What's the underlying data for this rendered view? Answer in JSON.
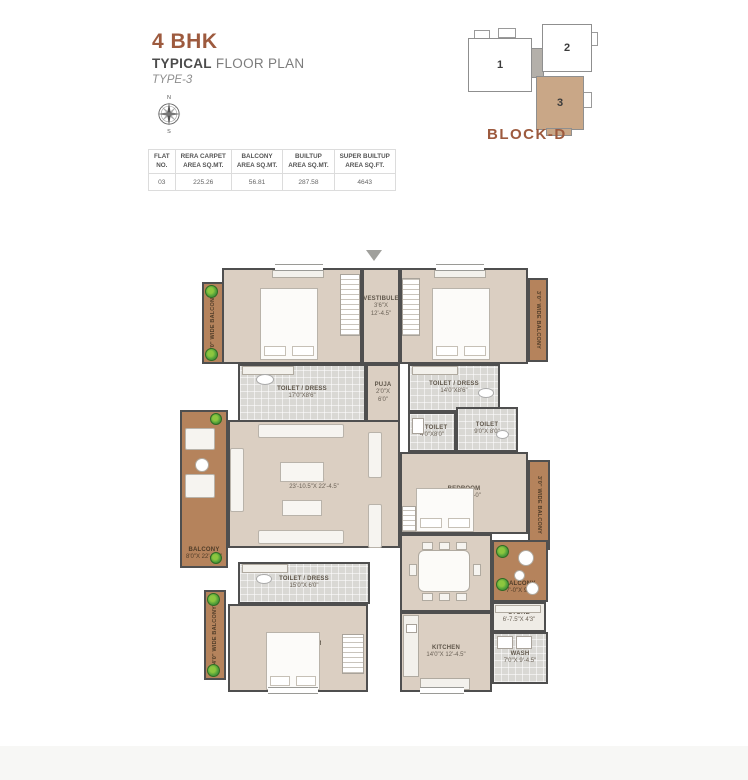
{
  "header": {
    "title": "4 BHK",
    "subtitle_bold": "TYPICAL",
    "subtitle_rest": " FLOOR PLAN",
    "type_label": "TYPE-3",
    "accent_color": "#9d5a3e"
  },
  "compass": {
    "north": "N",
    "south": "S"
  },
  "key_plan": {
    "units": [
      "1",
      "2",
      "3"
    ],
    "caption_prefix": "BLOCK-",
    "caption_bold": "D",
    "highlight_color": "#c9a787"
  },
  "table": {
    "headers": [
      "FLAT\nNO.",
      "RERA CARPET\nAREA SQ.MT.",
      "BALCONY\nAREA SQ.MT.",
      "BUILTUP\nAREA SQ.MT.",
      "SUPER BUILTUP\nAREA SQ.FT."
    ],
    "rows": [
      [
        "03",
        "225.26",
        "56.81",
        "287.58",
        "4643"
      ]
    ]
  },
  "plan": {
    "colors": {
      "room": "#dbcfc2",
      "balcony": "#b5835c",
      "wet": "#d9d8d4",
      "wall": "#4f4f4f",
      "plant": "#4e9d3a"
    },
    "rooms": [
      {
        "id": "bedroom-top-left",
        "label": "BEDROOM",
        "dims": "18'0\"X12'0\"",
        "x": 42,
        "y": 6,
        "w": 140,
        "h": 96,
        "type": "room"
      },
      {
        "id": "balcony-top-left",
        "label": "4'0\" WIDE BALCONY",
        "x": 22,
        "y": 20,
        "w": 22,
        "h": 82,
        "type": "balcony",
        "orient": "v-up"
      },
      {
        "id": "vestibule",
        "label": "VESTIBULE",
        "dims": "3'6\"X\n12'-4.5\"",
        "x": 182,
        "y": 6,
        "w": 38,
        "h": 96,
        "type": "room",
        "align": "top"
      },
      {
        "id": "bedroom-top-right",
        "label": "BEDROOM",
        "dims": "18'0\"X12'0\"",
        "x": 220,
        "y": 6,
        "w": 128,
        "h": 96,
        "type": "room"
      },
      {
        "id": "balcony-top-right",
        "label": "3'0\" WIDE BALCONY",
        "x": 348,
        "y": 16,
        "w": 20,
        "h": 84,
        "type": "balcony",
        "orient": "v-down"
      },
      {
        "id": "toilet-dress-1",
        "label": "TOILET / DRESS",
        "dims": "17'0\"X8'6\"",
        "x": 58,
        "y": 102,
        "w": 128,
        "h": 58,
        "type": "wet"
      },
      {
        "id": "puja",
        "label": "PUJA",
        "dims": "2'0\"X\n6'0\"",
        "x": 186,
        "y": 102,
        "w": 34,
        "h": 58,
        "type": "room"
      },
      {
        "id": "toilet-dress-2",
        "label": "TOILET / DRESS",
        "dims": "14'0\"X8'6\"",
        "x": 228,
        "y": 102,
        "w": 92,
        "h": 48,
        "type": "wet"
      },
      {
        "id": "c-toilet",
        "label": "C. TOILET",
        "dims": "4'0\"X8'0\"",
        "x": 228,
        "y": 150,
        "w": 48,
        "h": 40,
        "type": "wet"
      },
      {
        "id": "toilet",
        "label": "TOILET",
        "dims": "9'0\"X 8'0\"",
        "x": 276,
        "y": 145,
        "w": 62,
        "h": 45,
        "type": "wet"
      },
      {
        "id": "bedroom-mid-right",
        "label": "BEDROOM",
        "dims": "18'0\"X 11'-0\"",
        "x": 220,
        "y": 190,
        "w": 128,
        "h": 82,
        "type": "room"
      },
      {
        "id": "balcony-mid-right",
        "label": "3'0\" WIDE BALCONY",
        "x": 348,
        "y": 198,
        "w": 22,
        "h": 90,
        "type": "balcony",
        "orient": "v-down"
      },
      {
        "id": "balcony-left",
        "label": "BALCONY",
        "dims": "8'0\"X 22'-4.5\"",
        "x": 0,
        "y": 148,
        "w": 48,
        "h": 158,
        "type": "balcony",
        "align": "bottom"
      },
      {
        "id": "living",
        "label": "LIVING",
        "dims": "23'-10.5\"X 22'-4.5\"",
        "x": 48,
        "y": 158,
        "w": 172,
        "h": 128,
        "type": "room"
      },
      {
        "id": "dining",
        "label": "DINING",
        "dims": "14'-4.5\"X 11'-0\"",
        "x": 220,
        "y": 272,
        "w": 92,
        "h": 78,
        "type": "room"
      },
      {
        "id": "balcony-bottom-right",
        "label": "BALCONY",
        "dims": "7'-0\"X 9'9\"",
        "x": 312,
        "y": 278,
        "w": 56,
        "h": 62,
        "type": "balcony",
        "align": "bottom"
      },
      {
        "id": "store",
        "label": "STORE",
        "dims": "6'-7.5\"X 4'3\"",
        "x": 312,
        "y": 340,
        "w": 54,
        "h": 30,
        "type": "store"
      },
      {
        "id": "wash",
        "label": "WASH",
        "dims": "7'0\"X 9'-4.5\"",
        "x": 312,
        "y": 370,
        "w": 56,
        "h": 52,
        "type": "wet"
      },
      {
        "id": "kitchen",
        "label": "KITCHEN",
        "dims": "14'0\"X 12'-4.5\"",
        "x": 220,
        "y": 350,
        "w": 92,
        "h": 80,
        "type": "room"
      },
      {
        "id": "toilet-dress-3",
        "label": "TOILET / DRESS",
        "dims": "15'0\"X 6'0\"",
        "x": 58,
        "y": 300,
        "w": 132,
        "h": 42,
        "type": "wet"
      },
      {
        "id": "bedroom-bottom-left",
        "label": "2ND BEDROOM",
        "dims": "18'0\"X 12'-0\"",
        "x": 48,
        "y": 342,
        "w": 140,
        "h": 88,
        "type": "room"
      },
      {
        "id": "balcony-bottom-left",
        "label": "4'0\" WIDE BALCONY",
        "x": 24,
        "y": 328,
        "w": 22,
        "h": 90,
        "type": "balcony",
        "orient": "v-up"
      }
    ]
  }
}
